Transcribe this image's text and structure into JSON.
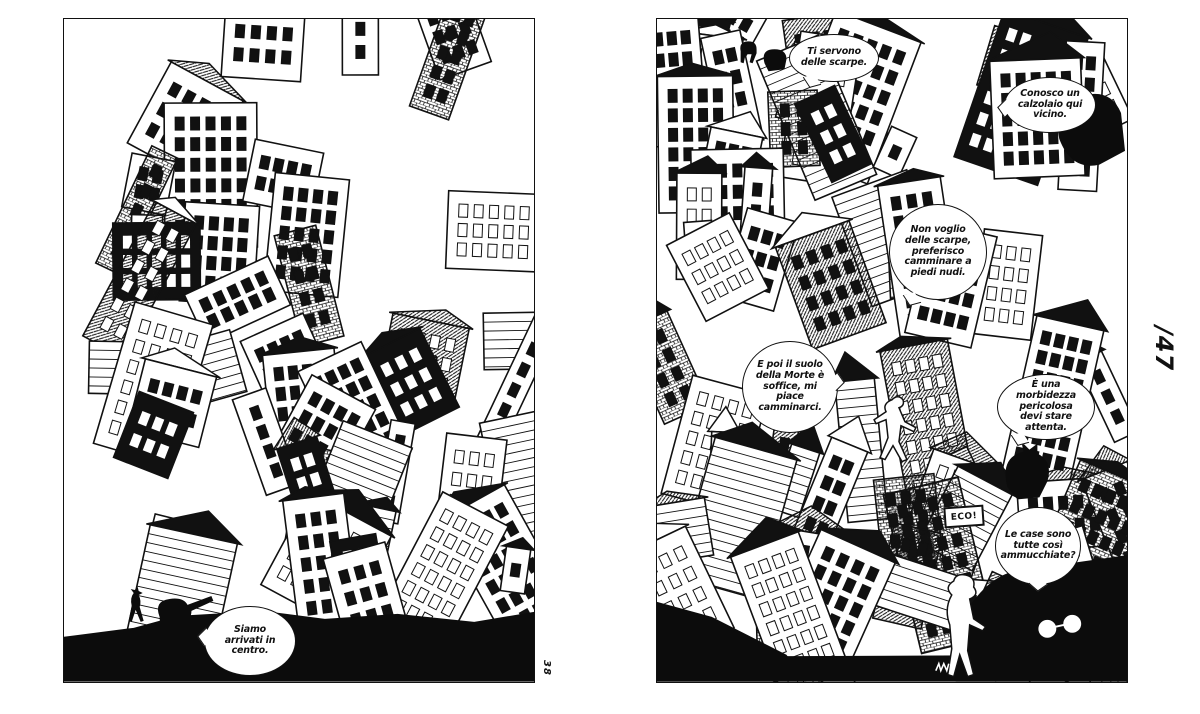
{
  "spread": {
    "page_label": "/47",
    "left_page": {
      "corner_mark": "38",
      "bubbles": {
        "siamo": "Siamo arrivati in centro."
      }
    },
    "right_page": {
      "sign_eco": "ECO!",
      "bubbles": {
        "ti_servono": "Ti servono delle scarpe.",
        "conosco": "Conosco un calzolaio qui vicino.",
        "non_voglio": "Non voglio delle scarpe, preferisco camminare a piedi nudi.",
        "e_poi": "E poi il suolo della Morte è soffice, mi piace camminarci.",
        "morbidezza": "È una morbidezza pericolosa devi stare attenta.",
        "le_case": "Le case sono tutte così ammucchiate?"
      }
    },
    "colors": {
      "ink": "#111111",
      "paper": "#ffffff"
    }
  }
}
